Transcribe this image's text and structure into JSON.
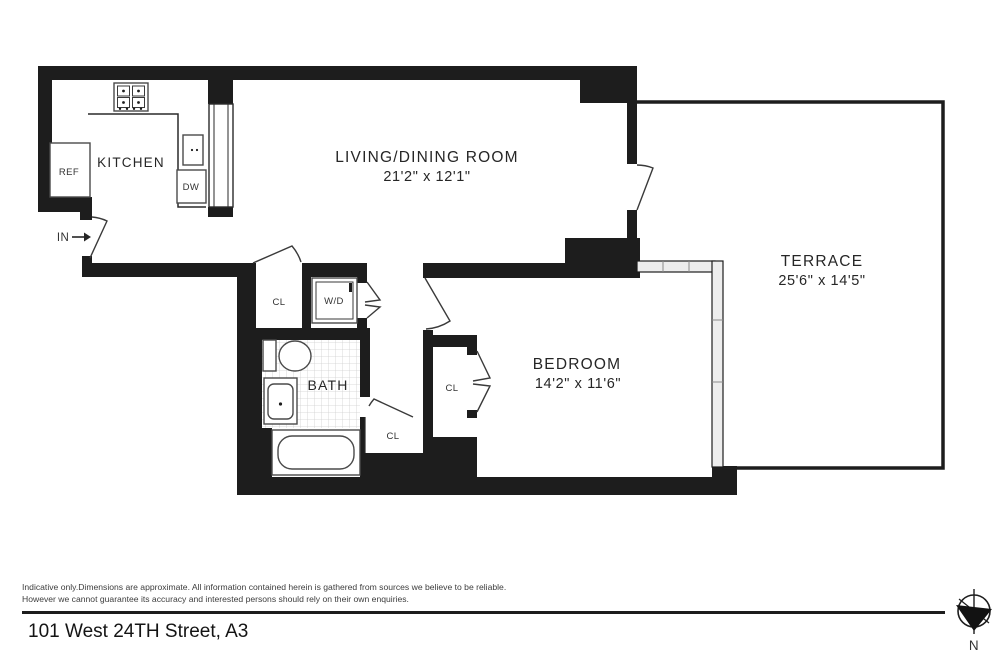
{
  "plan": {
    "rooms": {
      "kitchen": {
        "label": "KITCHEN"
      },
      "living_dining": {
        "label": "LIVING/DINING ROOM",
        "dimensions": "21'2\" x 12'1\""
      },
      "bedroom": {
        "label": "BEDROOM",
        "dimensions": "14'2\" x 11'6\""
      },
      "terrace": {
        "label": "TERRACE",
        "dimensions": "25'6\" x 14'5\""
      },
      "bath": {
        "label": "BATH"
      }
    },
    "fixtures": {
      "refrigerator": "REF",
      "dishwasher": "DW",
      "washer_dryer": "W/D",
      "closet": "CL",
      "entry": "IN"
    }
  },
  "footer": {
    "disclaimer_line1": "Indicative only.Dimensions are approximate. All information contained herein is gathered from sources we believe to be reliable.",
    "disclaimer_line2": "However we cannot guarantee its accuracy and interested persons should rely on their own enquiries.",
    "address": "101 West 24TH Street, A3",
    "compass": "N"
  },
  "colors": {
    "wall": "#1d1d1d",
    "background": "#ffffff",
    "window_fill": "#ededed",
    "text": "#262626"
  }
}
